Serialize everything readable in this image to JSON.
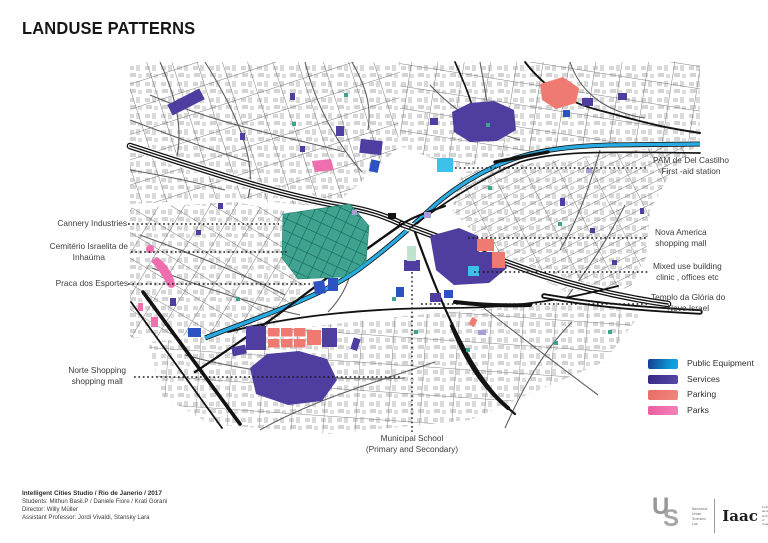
{
  "title": "LANDUSE PATTERNS",
  "labels": {
    "cannery": "Cannery Industries",
    "cemiterio1": "Cemitério Israelita de",
    "cemiterio2": "Inhaúma",
    "praca": "Praca dos Esportes",
    "norte1": "Norte Shopping",
    "norte2": "shopping mall",
    "pam1": "PAM de Del Castilho",
    "pam2": "First -aid station",
    "nova1": "Nova America",
    "nova2": "shopping mall",
    "mixed1": "Mixed use building",
    "mixed2": "clinic , offices etc",
    "templo1": "Templo da Glória do",
    "templo2": "Novo Israel",
    "school1": "Municipal School",
    "school2": "(Primary and Secondary)"
  },
  "legend": {
    "items": [
      {
        "label": "Public Equipment",
        "color_start": "#173c8e",
        "color_end": "#0d9bd8"
      },
      {
        "label": "Services",
        "color_start": "#342a84",
        "color_end": "#5747ab"
      },
      {
        "label": "Parking",
        "color_start": "#e96d64",
        "color_end": "#f1867e"
      },
      {
        "label": "Parks",
        "color_start": "#ec5da0",
        "color_end": "#f482bb"
      }
    ]
  },
  "credits": {
    "line1": "Intelligent Cities Studio / Rio de Janerio / 2017",
    "line2": "Students:  Mithun Basil.P / Daniele Fiore / Krati Gorani",
    "line3": "Director: Willy Müller",
    "line4": "Assistant Professor: Jordi Vivaldi, Stansky Lara"
  },
  "logos": {
    "monogram_u": "U",
    "monogram_s": "S",
    "busl_sub": [
      "Barcelona",
      "Urban",
      "Sciences",
      "Lab"
    ],
    "iaac": "Iaac",
    "iaac_sub": [
      "institute for",
      "advanced",
      "architecture",
      "of Catalonia"
    ]
  },
  "map_colors": {
    "public_equipment_cyan": "#3ec1e8",
    "public_equipment_blue": "#2d53c3",
    "services_purple": "#4f3da0",
    "parking_salmon": "#ee7a72",
    "parks_pink": "#ef6fae",
    "cemetery_teal": "#3fa390",
    "river_cyan": "#29abe2",
    "highway_black": "#121212",
    "street_gray": "#6e6e6e",
    "building_gray": "#d6d6d6"
  }
}
